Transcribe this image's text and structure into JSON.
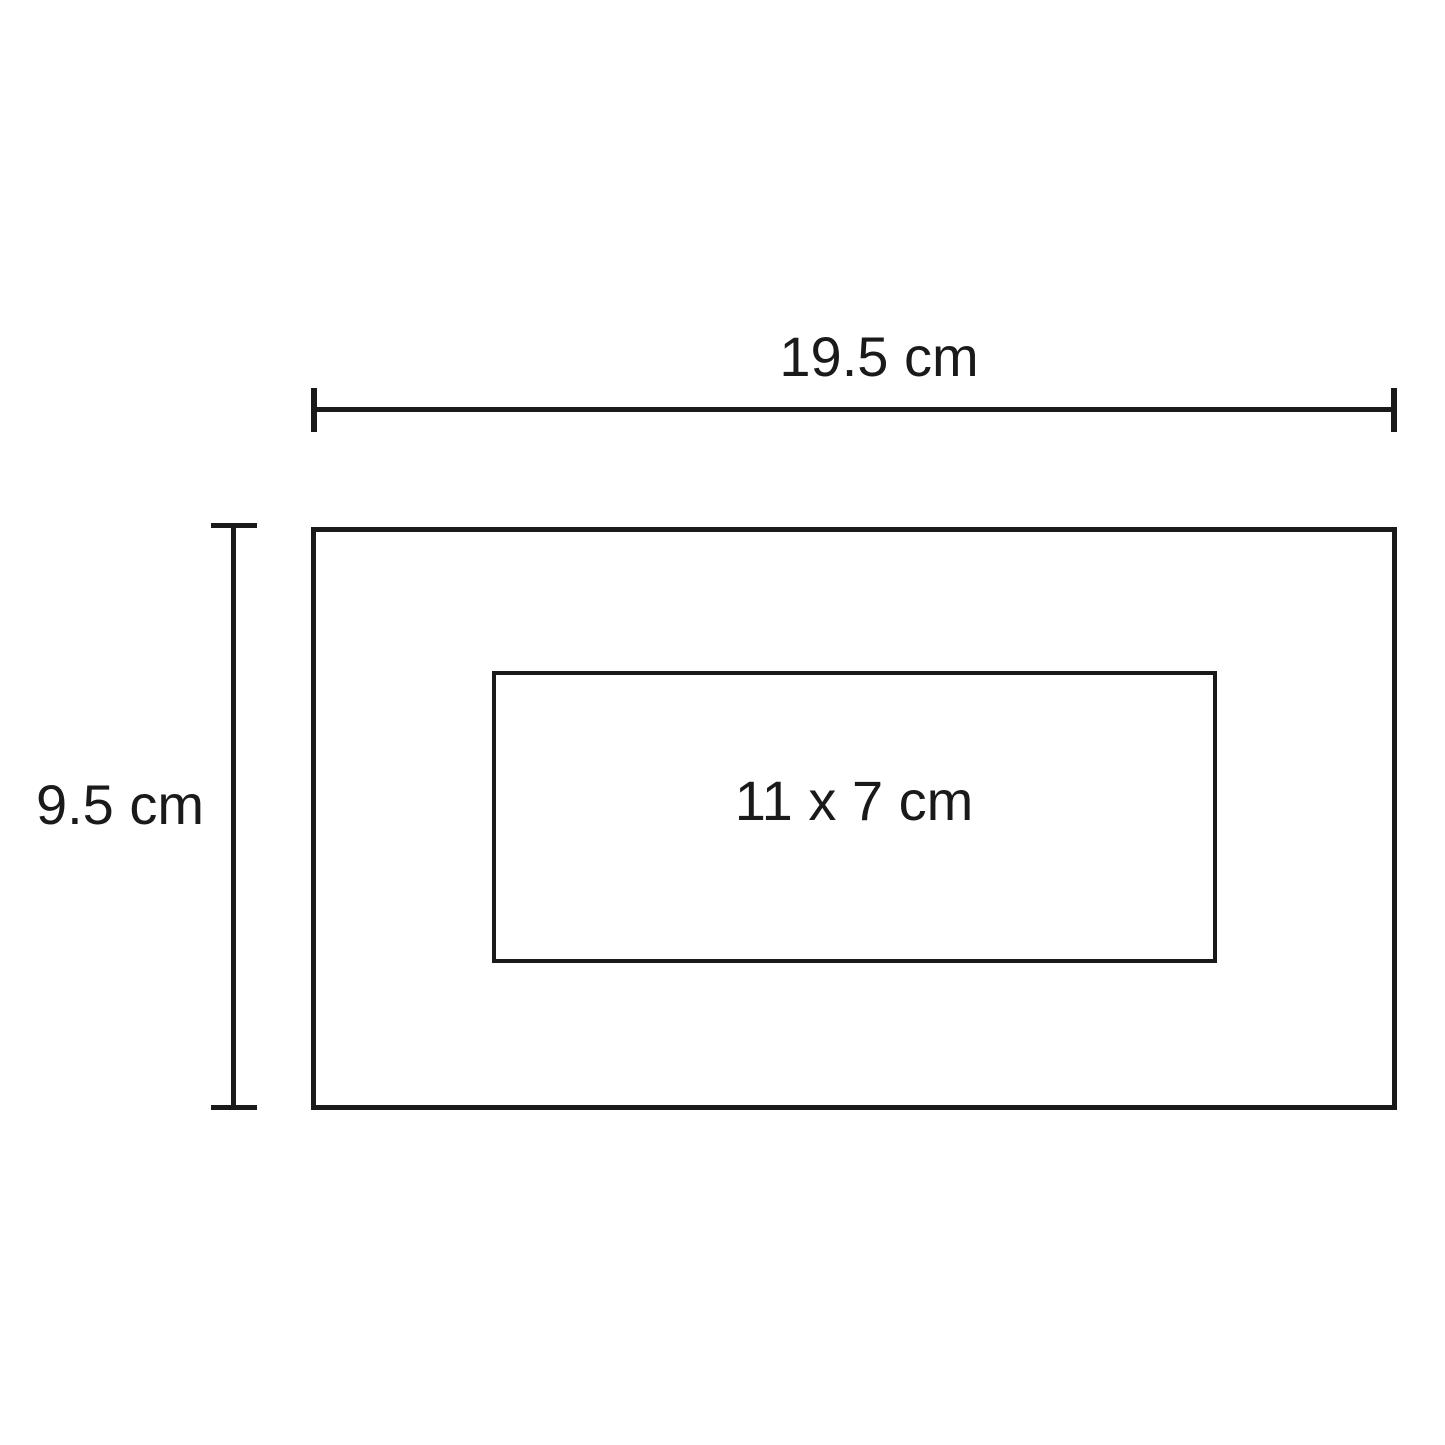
{
  "diagram": {
    "type": "dimension-drawing",
    "dimensions": {
      "width": {
        "label": "19.5 cm"
      },
      "height": {
        "label": "9.5 cm"
      },
      "inner": {
        "label": "11 x 7 cm"
      }
    },
    "colors": {
      "line": "#1a1a1a",
      "text": "#1a1a1a",
      "background": "#ffffff"
    }
  }
}
